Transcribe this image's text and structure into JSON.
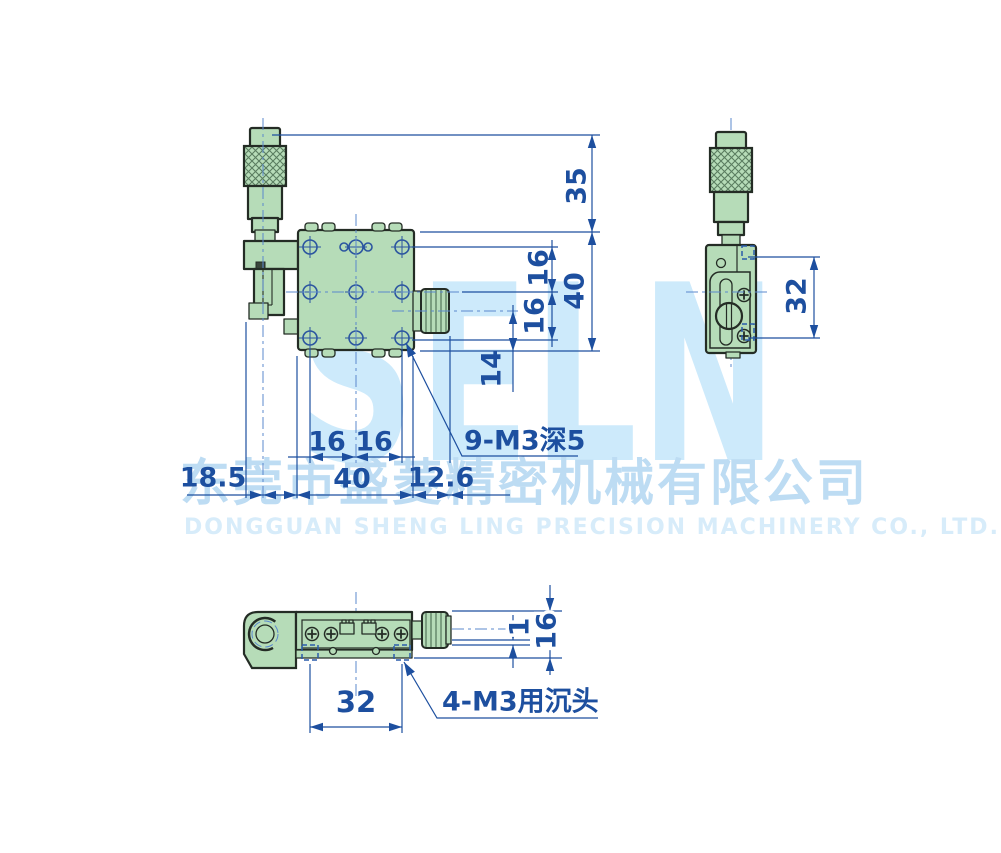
{
  "colors": {
    "background": "#ffffff",
    "part_fill_green": "#b6dcb8",
    "part_outline": "#242c25",
    "dimension_blue": "#1d4f9f",
    "centerline_blue": "#5b88cd",
    "hidden_line_blue": "#2a5cab",
    "watermark_logo": "#cdeafb",
    "watermark_cn": "#bddcf3",
    "watermark_en": "#d7ecfa"
  },
  "watermark": {
    "logo": "SELN",
    "company_cn": "东莞市盛菱精密机械有限公司",
    "company_en": "DONGGUAN SHENG LING PRECISION MACHINERY CO., LTD."
  },
  "front_view": {
    "dim_35": "35",
    "dim_16_pitch_upper": "16",
    "dim_16_pitch_lower": "16",
    "dim_40_height": "40",
    "dim_14": "14",
    "dim_16_pitch_left": "16",
    "dim_16_pitch_right": "16",
    "dim_40_width": "40",
    "dim_18_5": "18.5",
    "dim_12_6": "12.6",
    "hole_note": "9-M3深5"
  },
  "side_view": {
    "dim_32": "32"
  },
  "bottom_view": {
    "dim_32": "32",
    "dim_1": "1",
    "dim_16": "16",
    "hole_note": "4-M3用沉头"
  }
}
